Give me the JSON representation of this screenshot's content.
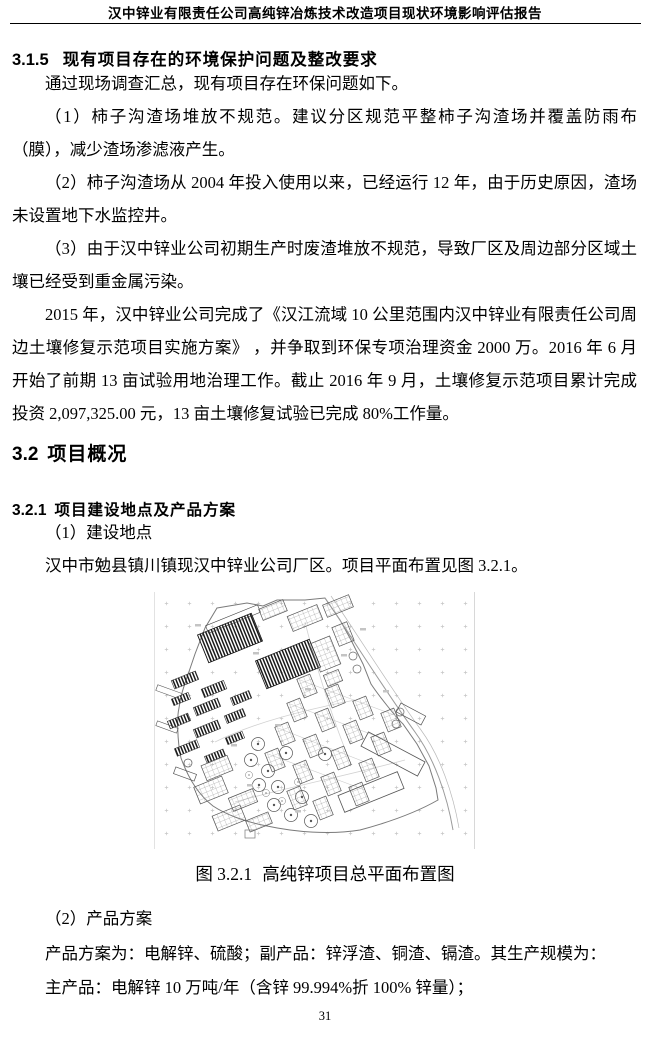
{
  "header": {
    "title": "汉中锌业有限责任公司高纯锌冶炼技术改造项目现状环境影响评估报告"
  },
  "headings": {
    "h315": {
      "number": "3.1.5",
      "text": "现有项目存在的环境保护问题及整改要求"
    },
    "h32": {
      "number": "3.2",
      "text": "项目概况"
    },
    "h321": {
      "number": "3.2.1",
      "text": "项目建设地点及产品方案"
    }
  },
  "paragraphs": {
    "p1": "通过现场调查汇总，现有项目存在环保问题如下。",
    "p2": "（1）柿子沟渣场堆放不规范。建议分区规范平整柿子沟渣场并覆盖防雨布（膜），减少渣场渗滤液产生。",
    "p3": "（2）柿子沟渣场从 2004 年投入使用以来，已经运行 12 年，由于历史原因，渣场未设置地下水监控井。",
    "p4": "（3）由于汉中锌业公司初期生产时废渣堆放不规范，导致厂区及周边部分区域土壤已经受到重金属污染。",
    "p5": "2015 年，汉中锌业公司完成了《汉江流域 10 公里范围内汉中锌业有限责任公司周边土壤修复示范项目实施方案》 ，并争取到环保专项治理资金 2000 万。2016 年 6 月开始了前期 13 亩试验用地治理工作。截止 2016 年 9 月，土壤修复示范项目累计完成投资 2,097,325.00 元，13 亩土壤修复试验已完成 80%工作量。",
    "p6": "（1）建设地点",
    "p7": "汉中市勉县镇川镇现汉中锌业公司厂区。项目平面布置见图 3.2.1。",
    "p8": "（2）产品方案",
    "p9": "产品方案为：电解锌、硫酸；副产品：锌浮渣、铜渣、镉渣。其生产规模为：",
    "p10": "主产品：电解锌 10 万吨/年（含锌 99.994%折 100% 锌量）；"
  },
  "figure": {
    "caption_label": "图 3.2.1",
    "caption_title": "高纯锌项目总平面布置图"
  },
  "footer": {
    "page_number": "31"
  }
}
